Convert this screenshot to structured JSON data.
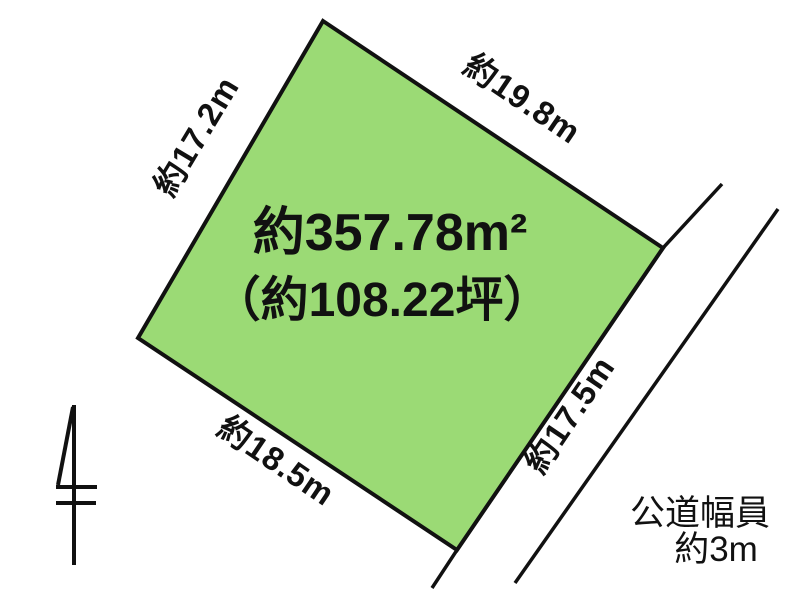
{
  "diagram": {
    "background_color": "#ffffff",
    "line_color": "#111111",
    "parcel": {
      "fill_color": "#9bda75",
      "area_label": "約357.78m²",
      "area_label_tsubo": "（約108.22坪）",
      "side_upper_left": "約17.2m",
      "side_upper_right": "約19.8m",
      "side_lower_left": "約18.5m",
      "side_road": "約17.5m"
    },
    "road": {
      "label_line1": "公道幅員",
      "label_line2": "約3m"
    },
    "icons": {
      "north_marker": "north-arrow-icon"
    }
  }
}
